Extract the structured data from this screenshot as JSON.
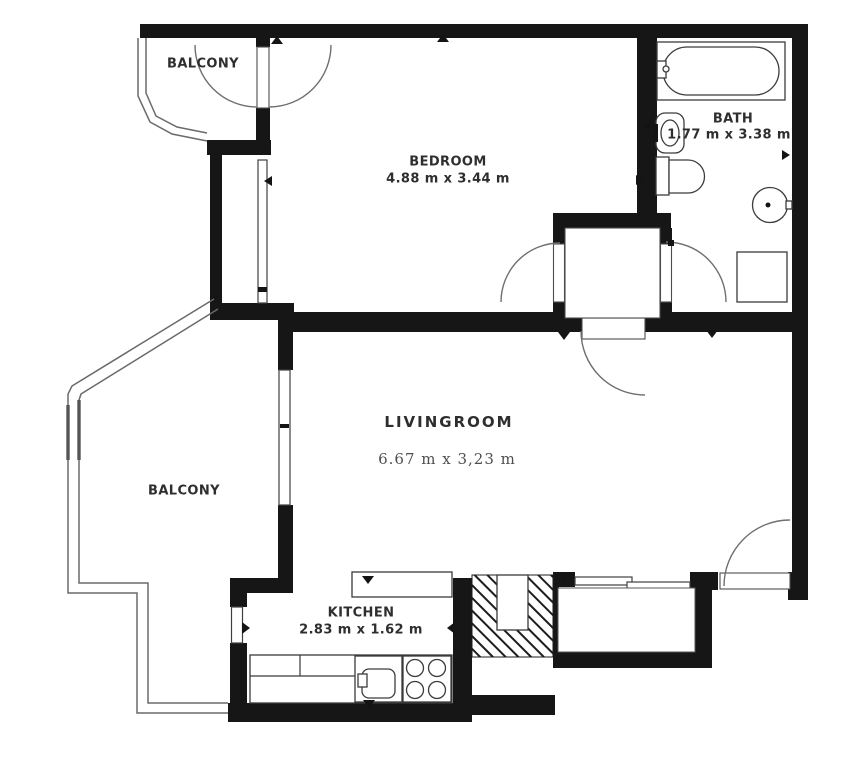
{
  "title": "Apartment floor plan",
  "colors": {
    "wall": "#161616",
    "line": "#6a6a6a",
    "fixture": "#3c3c3c",
    "text": "#2e2e2e",
    "dims_serif": "#4f4f4f",
    "bg": "#ffffff"
  },
  "rooms": {
    "balcony_top": {
      "label": "BALCONY"
    },
    "bedroom": {
      "label": "BEDROOM",
      "dims": "4.88 m x 3.44 m"
    },
    "bath": {
      "label": "BATH",
      "dims": "1.77 m x 3.38 m"
    },
    "livingroom": {
      "label": "LIVINGROOM",
      "dims": "6.67 m x 3,23 m"
    },
    "balcony_left": {
      "label": "BALCONY"
    },
    "kitchen": {
      "label": "KITCHEN",
      "dims": "2.83 m x 1.62 m"
    }
  }
}
